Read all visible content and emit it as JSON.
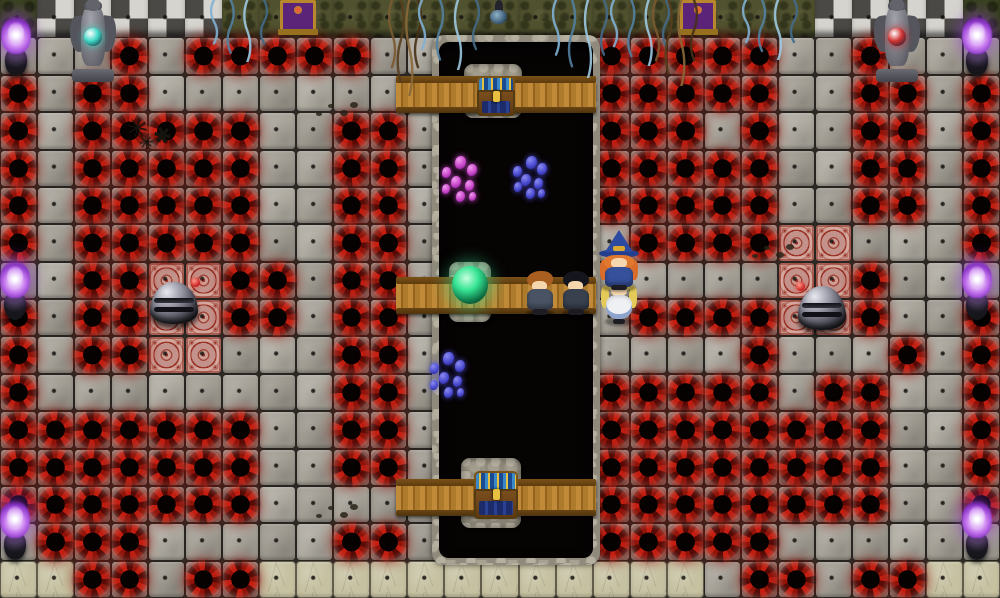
{
  "scene": {
    "width": 1000,
    "height": 598,
    "cols": 27,
    "rows": 16,
    "description": "RPG dungeon hall filled with red vortex traps around a central pit with three chest bridges"
  },
  "legend": {
    "g": "corner-moss-wall",
    "W": "checkered-stone-wall",
    "G": "mossy-wall",
    ".": "stone-floor",
    "o": "vortex-trap",
    "p": "pit",
    "s": "sand-floor",
    "a": "ornate-trap-tile"
  },
  "map": [
    "gWWWWWGGGGGGGGGGGGGGGGWWWWg",
    "...o.ooooo..ppppooooo..o...",
    "o.oo........ppppooooo..oo.o",
    "o.ooooo..oo.ppppooo.o..oo.o",
    "o.ooooo..oo.ppppooooo..oo.o",
    "o.ooooo..oo.ppppooooo..oo.o",
    "o.ooooo..oo.pppp.ooooaa...o",
    "..ooaaoo.oo.pppp.....aao...",
    "o.ooaaoo.oo.pppp.ooooaao..o",
    "o.ooaa...oo.pppp....o...o.o",
    "o........oo.ppppooooo.oo..o",
    "ooooooo..oo.ppppoooooooo..o",
    "ooooooo..oo.ppppoooooooo..o",
    "ooooooo.....ppppoooooooo..o",
    ".ooo.....oo.ppppooooo......",
    "ssoo.oossssssssssss.oo.ooss"
  ],
  "palette": {
    "floor": "#a49f95",
    "grout": "#2d2a25",
    "vortex_red": "#b2190f",
    "vortex_core": "#070303",
    "pit": "#070404",
    "pit_rim": "#968f80",
    "sand": "#c6c1a1",
    "wall_light": "#d6d4ce",
    "wall_dark": "#4b4945",
    "moss_wall": "#50522f",
    "wood": "#bd8a36",
    "ornate": "#c3938b",
    "flame_purple": "#a64fe0",
    "teal_orb": "#3fd8c6",
    "red_orb": "#d03232",
    "green_orb": "#35e493"
  },
  "pit_overlay": {
    "x": 432,
    "y": 35,
    "w": 168,
    "h": 530
  },
  "bridges": [
    {
      "name": "top-bridge-fence",
      "x": 396,
      "y": 76,
      "w": 200,
      "h": 37
    },
    {
      "name": "middle-bridge-fence",
      "x": 396,
      "y": 277,
      "w": 200,
      "h": 37
    },
    {
      "name": "bottom-bridge-fence",
      "x": 396,
      "y": 479,
      "w": 200,
      "h": 37
    }
  ],
  "pillars": [
    {
      "name": "top-bridge-pillar",
      "x": 464,
      "y": 64,
      "w": 58,
      "h": 54
    },
    {
      "name": "middle-bridge-pillar",
      "x": 449,
      "y": 262,
      "w": 42,
      "h": 60
    },
    {
      "name": "bottom-bridge-pillar",
      "x": 461,
      "y": 458,
      "w": 60,
      "h": 70
    }
  ],
  "chests": [
    {
      "name": "top-chest",
      "x": 477,
      "y": 76,
      "w": 38,
      "h": 40
    },
    {
      "name": "bottom-chest",
      "x": 474,
      "y": 471,
      "w": 44,
      "h": 48
    }
  ],
  "statues": [
    {
      "name": "gargoyle-statue-left",
      "x": 70,
      "y": -2,
      "w": 46,
      "h": 84,
      "orb": "#3fd8c6"
    },
    {
      "name": "gargoyle-statue-right",
      "x": 874,
      "y": -2,
      "w": 46,
      "h": 84,
      "orb": "#d03232"
    }
  ],
  "torches": [
    {
      "name": "purple-torch-top-left",
      "x": 1,
      "y": 16
    },
    {
      "name": "purple-torch-mid-left",
      "x": 0,
      "y": 260
    },
    {
      "name": "purple-torch-bottom-left",
      "x": 0,
      "y": 500
    },
    {
      "name": "purple-torch-top-right",
      "x": 962,
      "y": 16
    },
    {
      "name": "purple-torch-mid-right",
      "x": 962,
      "y": 260
    },
    {
      "name": "purple-torch-bottom-right",
      "x": 962,
      "y": 500
    }
  ],
  "wall_decor": [
    {
      "type": "altar",
      "name": "wall-altar-left",
      "x": 280,
      "y": 0,
      "w": 30,
      "h": 26
    },
    {
      "type": "altar",
      "name": "wall-altar-right",
      "x": 680,
      "y": 0,
      "w": 30,
      "h": 26
    },
    {
      "type": "lamp",
      "name": "wall-lamp-center",
      "x": 487,
      "y": 0,
      "w": 24,
      "h": 30
    }
  ],
  "vines": [
    {
      "variant": "blue",
      "name": "hanging-vines",
      "x": 210,
      "y": 0,
      "w": 58,
      "h": 62
    },
    {
      "variant": "brown",
      "name": "hanging-roots",
      "x": 388,
      "y": 0,
      "w": 34,
      "h": 96
    },
    {
      "variant": "blue",
      "name": "hanging-vines",
      "x": 418,
      "y": 0,
      "w": 62,
      "h": 70
    },
    {
      "variant": "blue",
      "name": "hanging-vines",
      "x": 552,
      "y": 0,
      "w": 56,
      "h": 78
    },
    {
      "variant": "blue",
      "name": "hanging-vines",
      "x": 610,
      "y": 0,
      "w": 60,
      "h": 66
    },
    {
      "variant": "brown",
      "name": "hanging-roots",
      "x": 652,
      "y": 0,
      "w": 46,
      "h": 86
    },
    {
      "variant": "blue",
      "name": "hanging-vines",
      "x": 742,
      "y": 0,
      "w": 56,
      "h": 60
    }
  ],
  "creatures": [
    {
      "variant": "pink",
      "name": "pit-tentacle-pink",
      "x": 436,
      "y": 152,
      "w": 46,
      "h": 56
    },
    {
      "variant": "blue",
      "name": "pit-tentacle-blue",
      "x": 508,
      "y": 152,
      "w": 42,
      "h": 52
    },
    {
      "variant": "blue",
      "name": "pit-tentacle-blue2",
      "x": 424,
      "y": 348,
      "w": 46,
      "h": 56
    }
  ],
  "domes": [
    {
      "name": "metal-dome-trap-left",
      "x": 150,
      "y": 282,
      "w": 48,
      "h": 42,
      "orb_side": "right"
    },
    {
      "name": "metal-dome-trap-right",
      "x": 798,
      "y": 286,
      "w": 48,
      "h": 44,
      "orb_side": "left"
    }
  ],
  "decals": [
    {
      "type": "caltrops",
      "name": "spike-caltrops",
      "x": 124,
      "y": 112,
      "w": 76,
      "h": 48
    },
    {
      "type": "footprints",
      "name": "footprint-trail",
      "x": 314,
      "y": 98,
      "w": 46,
      "h": 26
    },
    {
      "type": "footprints",
      "name": "footprint-trail",
      "x": 750,
      "y": 240,
      "w": 46,
      "h": 28
    },
    {
      "type": "footprints",
      "name": "footprint-trail",
      "x": 314,
      "y": 500,
      "w": 46,
      "h": 26
    }
  ],
  "green_orb": {
    "name": "green-crystal-orb",
    "x": 452,
    "y": 266,
    "w": 36,
    "h": 38
  },
  "characters": [
    {
      "name": "party-member-soldier",
      "variant": "soldier",
      "x": 523,
      "y": 270,
      "w": 34,
      "h": 48
    },
    {
      "name": "party-member-rogue",
      "variant": "rogue",
      "x": 559,
      "y": 270,
      "w": 34,
      "h": 48
    },
    {
      "name": "party-member-cleric",
      "variant": "cleric",
      "x": 601,
      "y": 272,
      "w": 36,
      "h": 54
    },
    {
      "name": "party-member-wizard",
      "variant": "wizard",
      "x": 598,
      "y": 230,
      "w": 42,
      "h": 62
    }
  ]
}
